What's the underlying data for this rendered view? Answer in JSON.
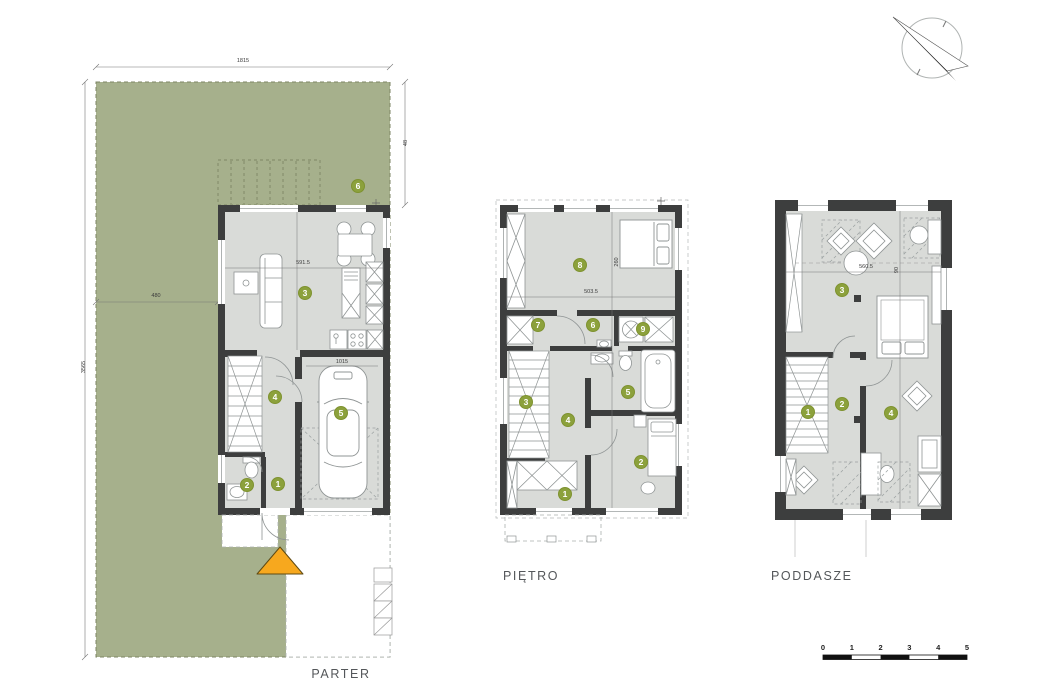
{
  "floors": [
    {
      "id": "parter",
      "label": "PARTER",
      "markers": [
        {
          "n": "6",
          "x": 358,
          "y": 186
        },
        {
          "n": "3",
          "x": 305,
          "y": 293
        },
        {
          "n": "4",
          "x": 275,
          "y": 397
        },
        {
          "n": "5",
          "x": 341,
          "y": 413
        },
        {
          "n": "2",
          "x": 247,
          "y": 485
        },
        {
          "n": "1",
          "x": 278,
          "y": 484
        }
      ],
      "dims": [
        {
          "text": "591.5",
          "x": 303,
          "y": 263
        },
        {
          "text": "1015",
          "x": 342,
          "y": 362
        }
      ]
    },
    {
      "id": "pietro",
      "label": "PIĘTRO",
      "markers": [
        {
          "n": "8",
          "x": 580,
          "y": 265
        },
        {
          "n": "7",
          "x": 538,
          "y": 325
        },
        {
          "n": "6",
          "x": 593,
          "y": 325
        },
        {
          "n": "9",
          "x": 643,
          "y": 329
        },
        {
          "n": "3",
          "x": 526,
          "y": 402
        },
        {
          "n": "5",
          "x": 628,
          "y": 392
        },
        {
          "n": "4",
          "x": 568,
          "y": 420
        },
        {
          "n": "2",
          "x": 641,
          "y": 462
        },
        {
          "n": "1",
          "x": 565,
          "y": 494
        }
      ],
      "dims": [
        {
          "text": "503.5",
          "x": 591,
          "y": 292
        },
        {
          "text": "260",
          "x": 617,
          "y": 262,
          "rot": 1
        }
      ]
    },
    {
      "id": "poddasze",
      "label": "PODDASZE",
      "markers": [
        {
          "n": "3",
          "x": 842,
          "y": 290
        },
        {
          "n": "1",
          "x": 808,
          "y": 412
        },
        {
          "n": "2",
          "x": 842,
          "y": 404
        },
        {
          "n": "4",
          "x": 891,
          "y": 413
        }
      ],
      "dims": [
        {
          "text": "560.5",
          "x": 866,
          "y": 267
        },
        {
          "text": "90",
          "x": 897,
          "y": 270,
          "rot": 1
        }
      ]
    }
  ],
  "site": {
    "dims": [
      {
        "text": "1815",
        "x": 243,
        "y": 61
      },
      {
        "text": "48",
        "x": 406,
        "y": 143,
        "rot": 1
      },
      {
        "text": "480",
        "x": 156,
        "y": 296
      },
      {
        "text": "3565",
        "x": 84,
        "y": 367,
        "rot": 1
      }
    ]
  },
  "scalebar": {
    "labels": [
      "0",
      "1",
      "2",
      "3",
      "4",
      "5"
    ]
  },
  "colors": {
    "garden": "#a6b08c",
    "floor": "#d9dbd8",
    "wall": "#3d3e3e",
    "marker": "#8ca13c",
    "entrance_arrow": "#f7a81e"
  }
}
